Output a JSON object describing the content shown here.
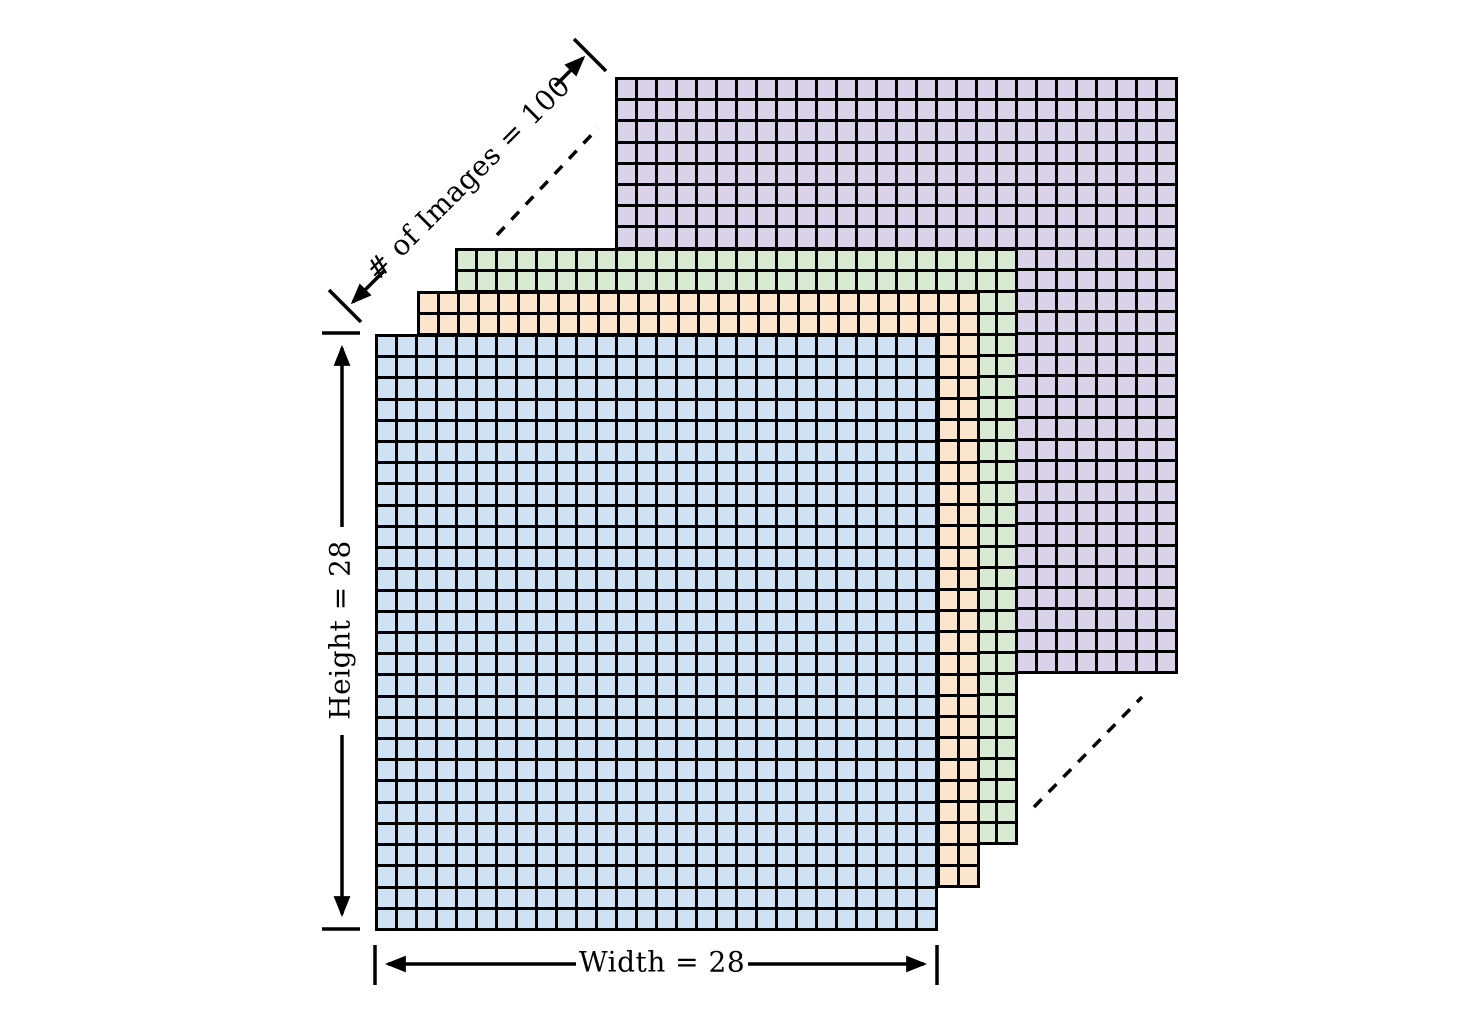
{
  "diagram": {
    "background_color": "#ffffff",
    "line_color": "#000000",
    "labels": {
      "height": "Height = 28",
      "width": "Width = 28",
      "num_images": "# of Images = 100"
    },
    "values": {
      "height": 28,
      "width": 28,
      "num_images": 100
    },
    "grid": {
      "rows": 28,
      "cols": 28,
      "grid_line_color": "#000000"
    },
    "layers": [
      {
        "name": "image-100-back",
        "color": "#d9d2e9",
        "x": 615,
        "y": 77,
        "z": 1
      },
      {
        "name": "image-3",
        "color": "#d9ead3",
        "x": 455,
        "y": 248,
        "z": 2
      },
      {
        "name": "image-2",
        "color": "#fce5cd",
        "x": 417,
        "y": 291,
        "z": 3
      },
      {
        "name": "image-1-front",
        "color": "#cfe2f3",
        "x": 375,
        "y": 334,
        "z": 4
      }
    ]
  }
}
